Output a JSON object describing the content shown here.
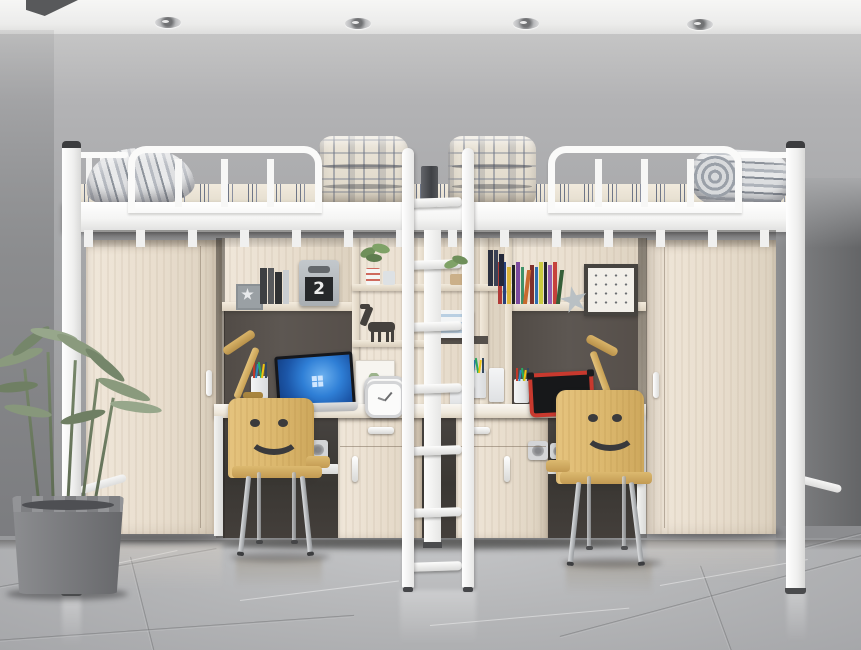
{
  "scene": {
    "title": "Dormitory loft bed unit with study desks, wardrobes and smiley chairs",
    "room": {
      "ceiling_color": "#f3f3f2",
      "wall_color": "#a7a8aa",
      "left_wall_shadow": "#7b7c7f",
      "right_wall_shadow": "#646567",
      "floor_color": "#b3b4b6",
      "floor_material": "glossy gray marble tile",
      "ceiling_light_count": 4
    },
    "bed": {
      "frame_color": "#f7f7f6",
      "material": "white metal",
      "parts": [
        "loft platform",
        "left guard rail",
        "right guard rail",
        "end slats",
        "corner posts",
        "center support post",
        "center ladder"
      ],
      "ladder_rung_count": 7
    },
    "bedding": {
      "items": [
        "rolled striped mattress left",
        "folded plaid quilt left",
        "folded plaid quilt right",
        "rolled striped mattress right"
      ],
      "mattress_base": "#ece5d8",
      "mattress_stripe": "#6e7687",
      "quilt_base": "#eae4d8",
      "quilt_line": "#6e7688"
    },
    "wardrobes": {
      "count": 2,
      "wood_color": "#ebe1d2",
      "handle_color": "#fafafa"
    },
    "left_shelf": {
      "block_number": "2",
      "items": [
        "star picture frame",
        "dark books",
        "number-2 flip block"
      ],
      "book_colors": [
        "#3e4043",
        "#57595c",
        "#2f3133",
        "#c9cdd1"
      ]
    },
    "right_shelf": {
      "items": [
        "colorful book row",
        "gray star ornament",
        "framed dot print"
      ],
      "book_colors": [
        "#b03a36",
        "#27407c",
        "#d9b43a",
        "#1f2123",
        "#7c4a9e",
        "#3f9168",
        "#c96a2e",
        "#802f2b",
        "#2e6db0",
        "#caca3f",
        "#20242a",
        "#985db1",
        "#c6423c",
        "#355e38"
      ]
    },
    "center_shelf": {
      "items": [
        "potted plants",
        "striped cups",
        "donkey figurine",
        "storage box",
        "picture frame",
        "white alarm clock",
        "pencil cup"
      ],
      "book_colors": [
        "#2c3140",
        "#3a4154",
        "#23283a"
      ]
    },
    "desks": {
      "count": 2,
      "top_color": "#f3eee6",
      "items_left": [
        "wooden desk lamp",
        "pencil cup",
        "laptop with blue screen",
        "white alarm clock"
      ],
      "items_right": [
        "white calculator box",
        "pencil cup",
        "red-frame tablet",
        "wooden desk lamp"
      ],
      "pencil_colors": [
        "#c0392b",
        "#2e86c1",
        "#27ae60",
        "#f1c40f",
        "#34495e"
      ]
    },
    "chairs": {
      "count": 2,
      "wood_color": "#dcb96f",
      "face": "smiley",
      "face_color": "#3a3a3c",
      "leg_color": "#b9bcc0"
    },
    "outlets": {
      "count": 3,
      "plate_color": "#d4d5d7"
    },
    "plant": {
      "pot_color": "#7b7c7f",
      "leaf_color": "#87987b",
      "stem_count": 5
    }
  }
}
